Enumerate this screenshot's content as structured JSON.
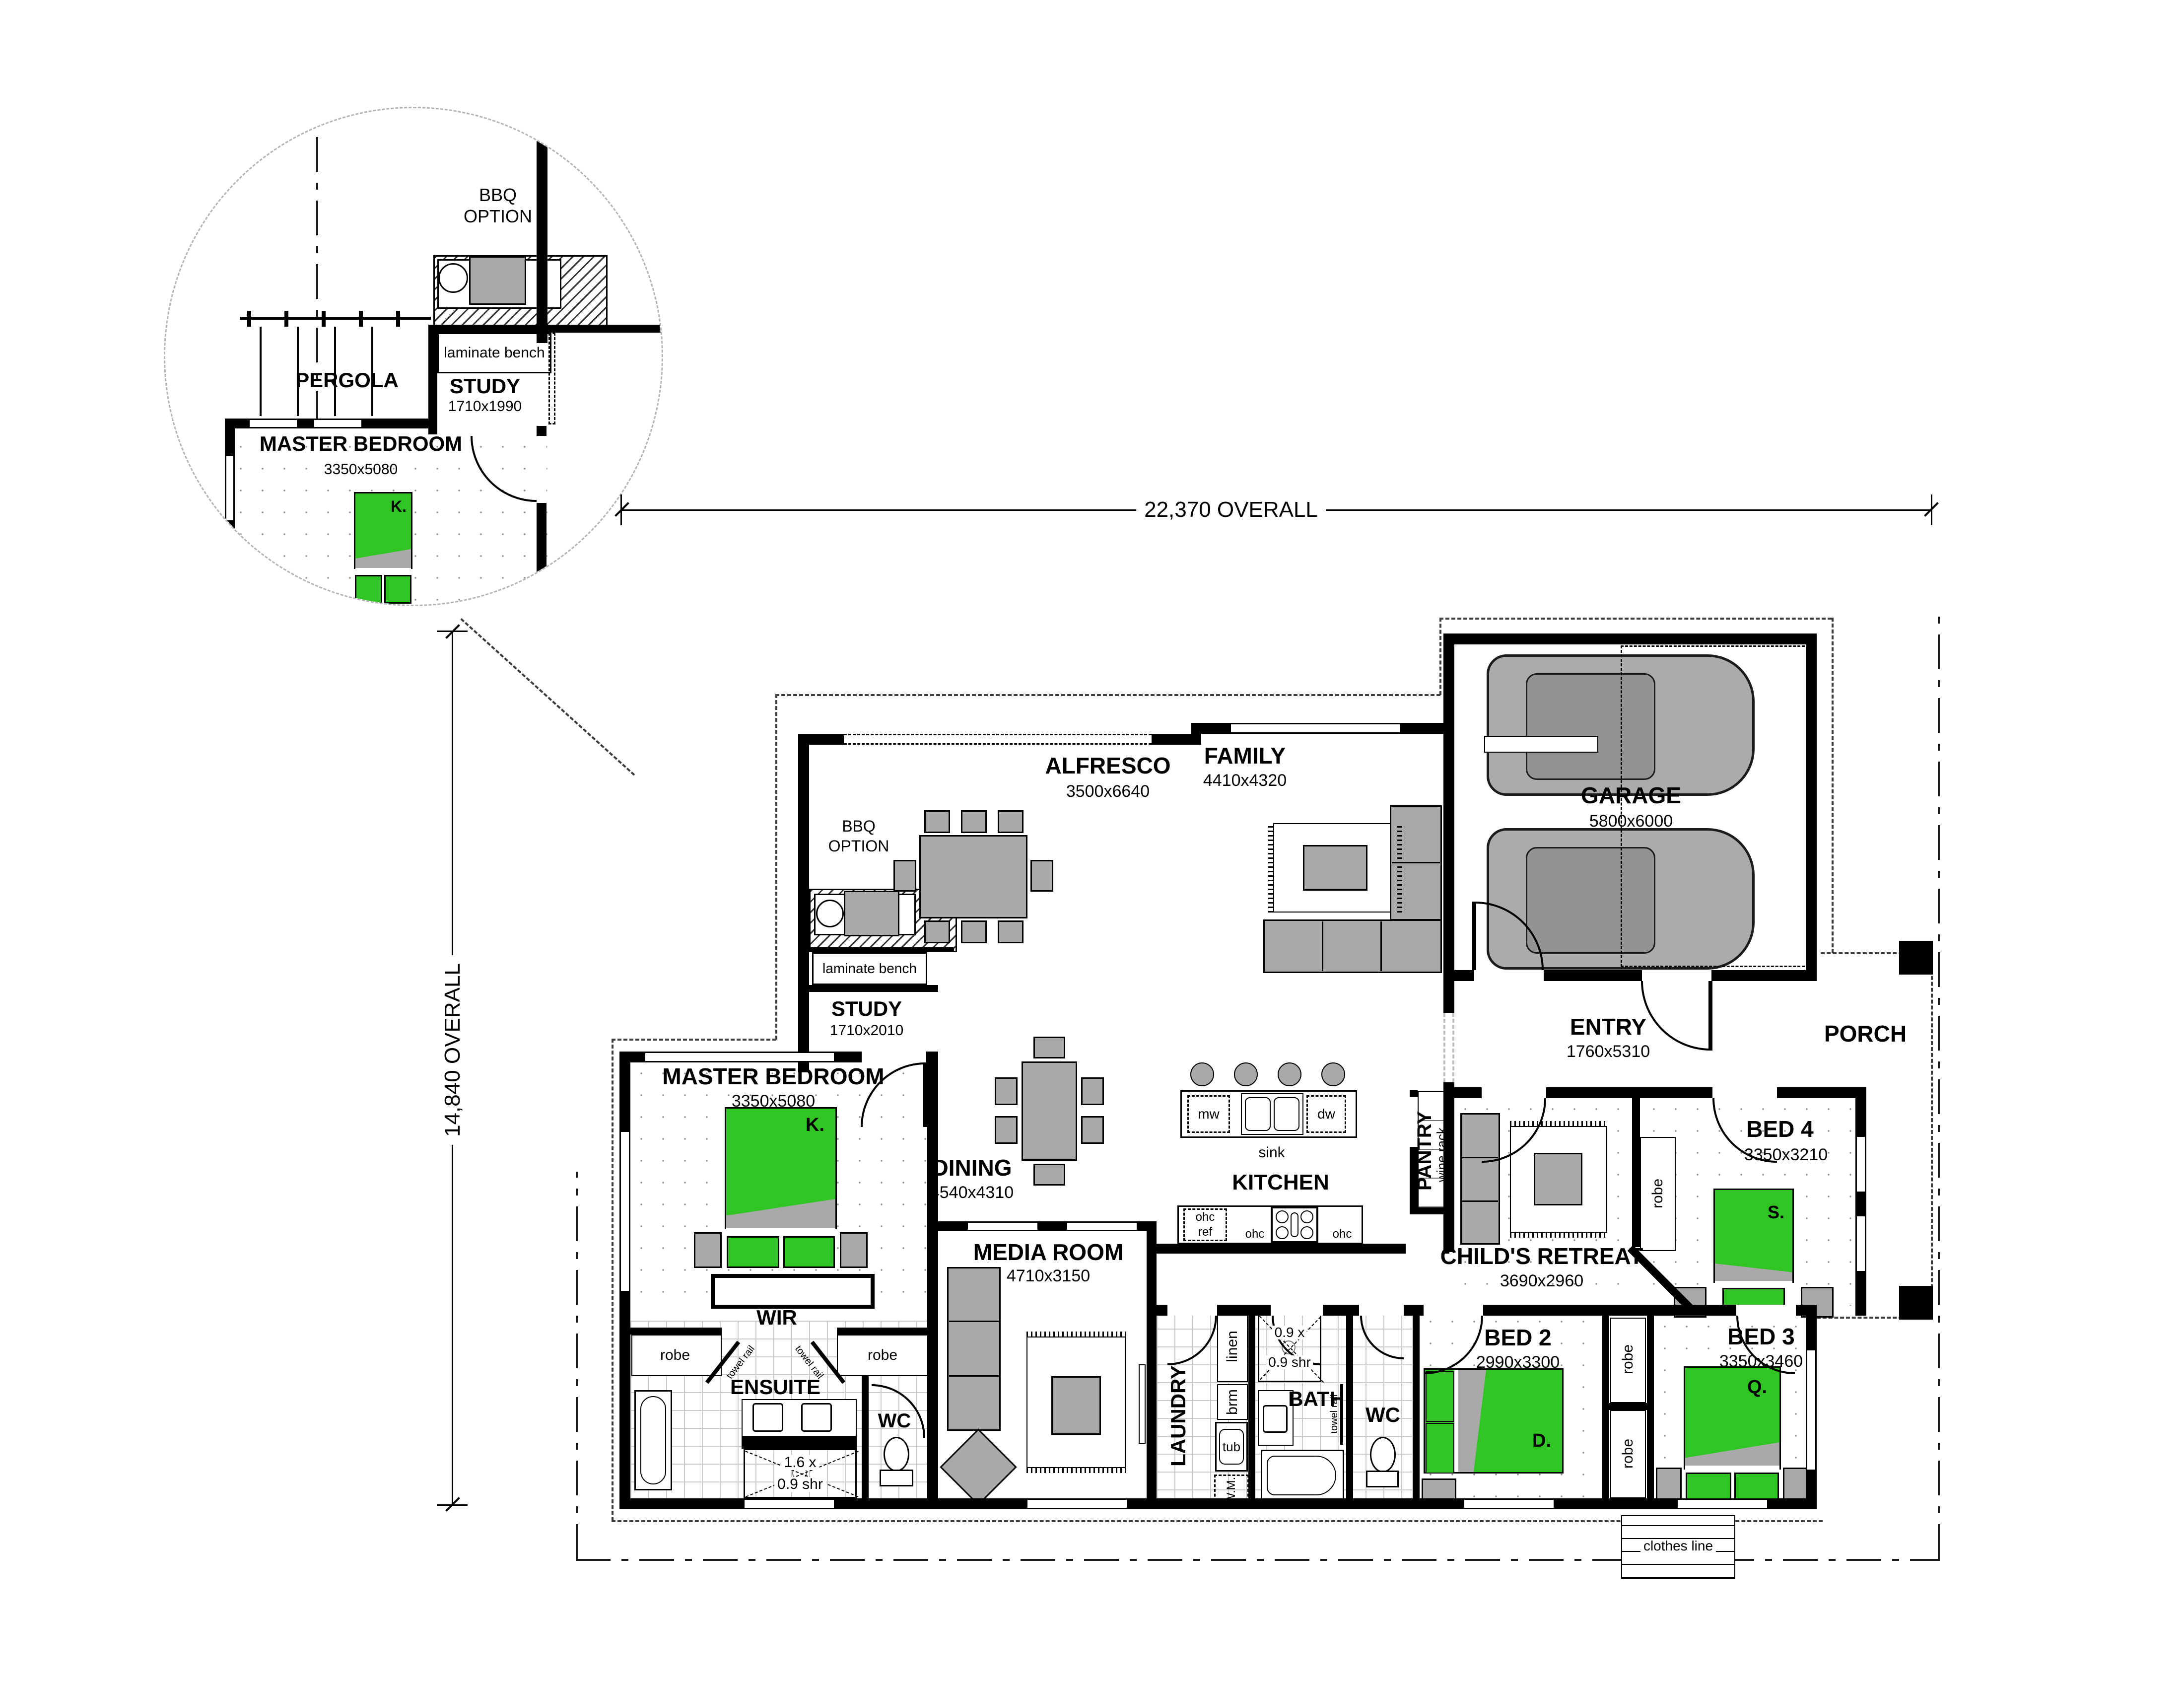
{
  "dims": {
    "overall_width": "22,370 OVERALL",
    "overall_height": "14,840 OVERALL"
  },
  "labels": {
    "bbq1": "BBQ",
    "bbq2": "OPTION",
    "pergola": "PERGOLA",
    "laminate_bench": "laminate bench",
    "robe": "robe",
    "towel_rail": "towel rail",
    "sink": "sink",
    "mw": "mw",
    "dw": "dw",
    "ohc": "ohc",
    "ref": "ref",
    "tub": "tub",
    "wm": "W.M.",
    "linen": "linen",
    "brm": "brm",
    "wc": "WC",
    "wine_rack": "wine rack",
    "clothes_line": "clothes line"
  },
  "rooms": {
    "inset_study": {
      "name": "STUDY",
      "size": "1710x1990"
    },
    "inset_master": {
      "name": "MASTER BEDROOM",
      "size": "3350x5080",
      "bed": "K."
    },
    "alfresco": {
      "name": "ALFRESCO",
      "size": "3500x6640"
    },
    "family": {
      "name": "FAMILY",
      "size": "4410x4320"
    },
    "garage": {
      "name": "GARAGE",
      "size": "5800x6000"
    },
    "entry": {
      "name": "ENTRY",
      "size": "1760x5310"
    },
    "porch": {
      "name": "PORCH"
    },
    "study": {
      "name": "STUDY",
      "size": "1710x2010"
    },
    "master": {
      "name": "MASTER BEDROOM",
      "size": "3350x5080",
      "bed": "K."
    },
    "wir": {
      "name": "WIR"
    },
    "ensuite": {
      "name": "ENSUITE",
      "shower1": "1.6 x",
      "shower2": "0.9 shr"
    },
    "dining": {
      "name": "DINING",
      "size": "4540x4310"
    },
    "kitchen": {
      "name": "KITCHEN"
    },
    "pantry": {
      "name": "PANTRY"
    },
    "media": {
      "name": "MEDIA ROOM",
      "size": "4710x3150"
    },
    "laundry": {
      "name": "LAUNDRY"
    },
    "bath": {
      "name": "BATH",
      "shower1": "0.9 x",
      "shower2": "0.9 shr"
    },
    "retreat": {
      "name": "CHILD'S RETREAT",
      "size": "3690x2960"
    },
    "bed2": {
      "name": "BED 2",
      "size": "2990x3300",
      "bed": "D."
    },
    "bed3": {
      "name": "BED 3",
      "size": "3350x3460",
      "bed": "Q."
    },
    "bed4": {
      "name": "BED 4",
      "size": "3350x3210",
      "bed": "S."
    }
  }
}
